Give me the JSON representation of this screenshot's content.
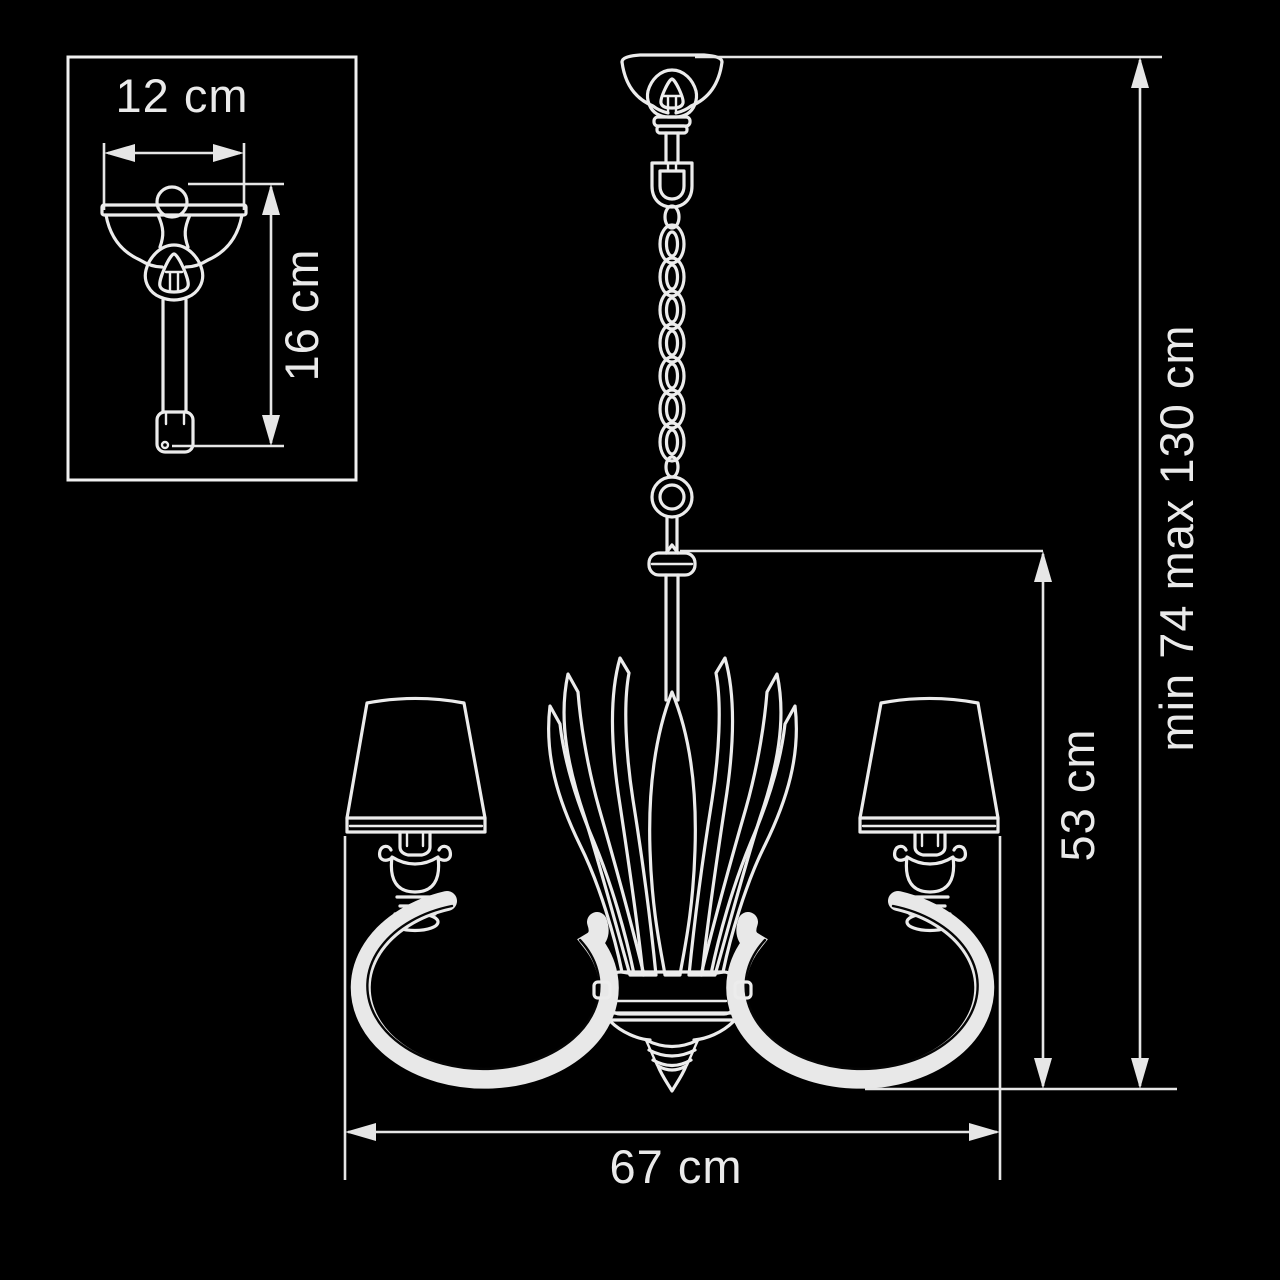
{
  "figure": {
    "type": "technical-dimension-diagram",
    "subject": "chandelier suspension light line drawing",
    "background_color": "#000000",
    "line_color": "#ececec",
    "text_color": "#eaeaea"
  },
  "labels": {
    "canopy_width": "12 cm",
    "canopy_height": "16 cm",
    "hanging_height": "min 74 max 130 cm",
    "fixture_height": "53 cm",
    "fixture_width": "67 cm"
  }
}
